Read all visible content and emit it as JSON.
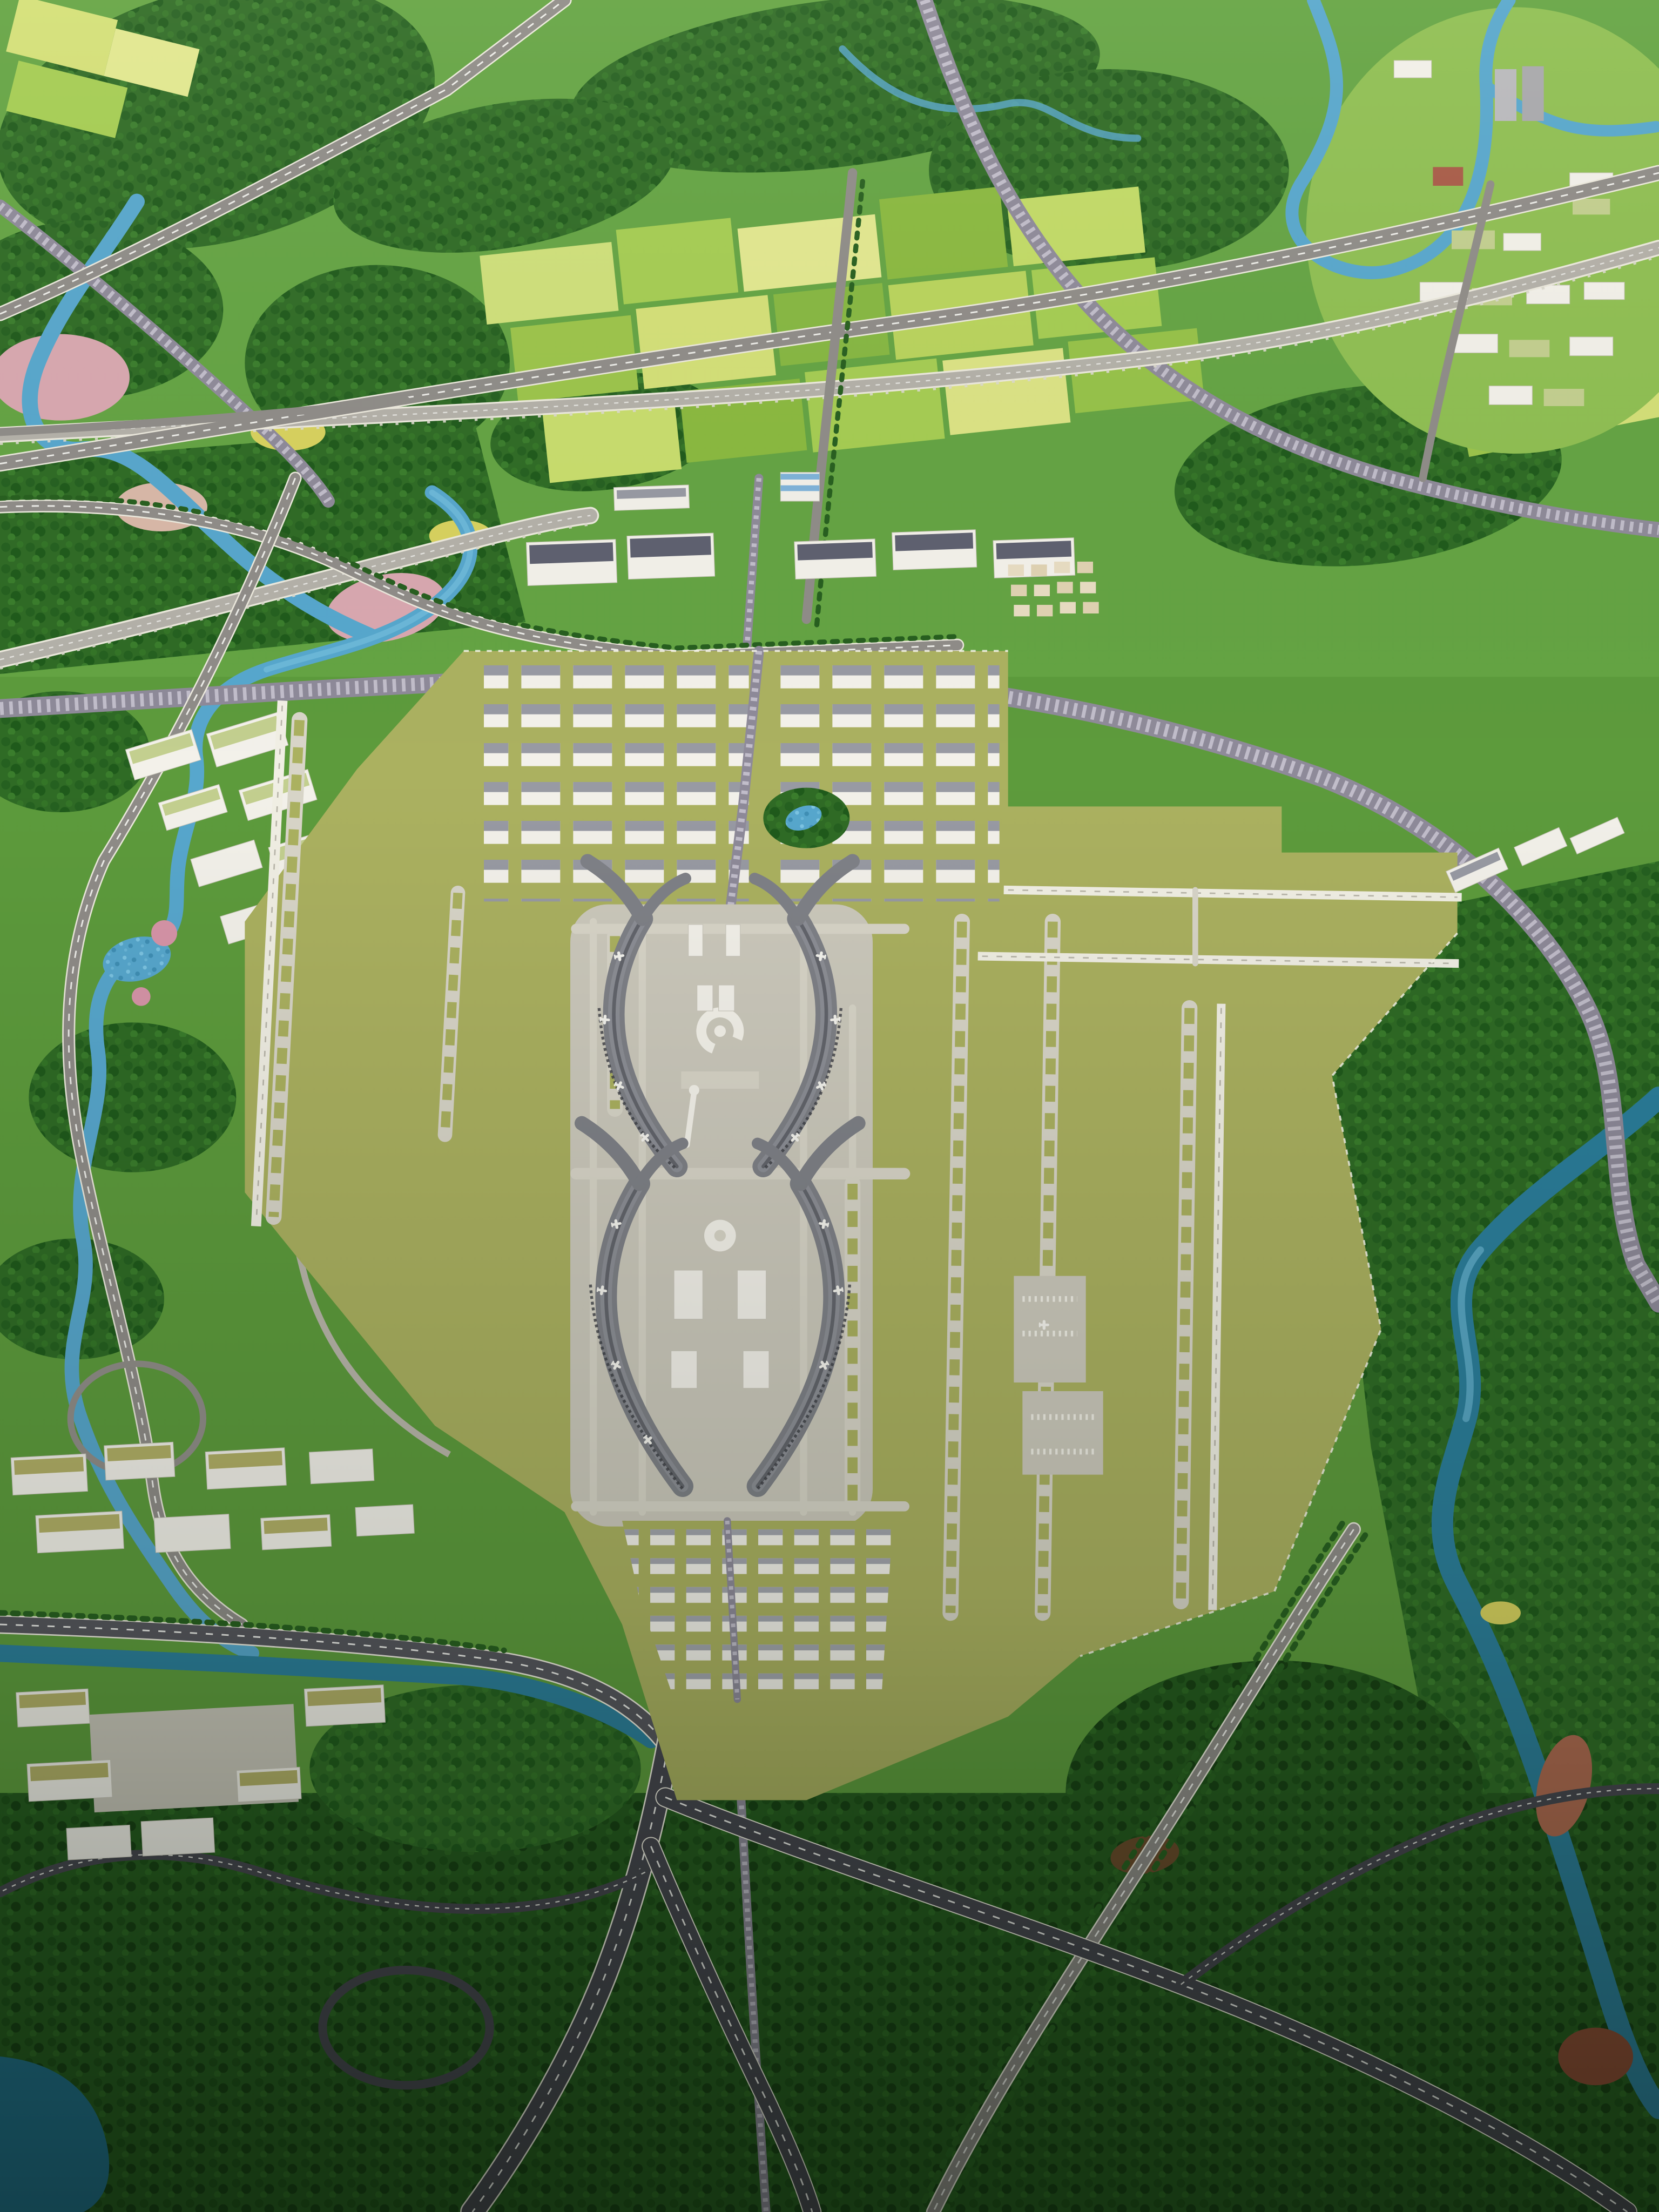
{
  "meta": {
    "title": "Aerial photograph of an airport planning scale model",
    "description": "Overhead photo of a physical architectural scale model: a twin-cluster hub airport with four swallow-wing concourses, olive airfield, white runways and loop taxiways, a logistics warehouse district to the north, a support business district to the south, surrounded by miniature forests, patchwork farmland, winding blue rivers with pink sandbars, elevated expressway viaducts, curved railway corridors and a motorway interchange in the darker foreground.",
    "visible_text": []
  },
  "palette": {
    "base_green": "#5d9b3c",
    "base_green_bright": "#64a443",
    "canopy_green": "#2f6b25",
    "canopy_dark": "#1e4f19",
    "field_light": "#cfe07a",
    "field_mid": "#a5cd52",
    "field_deep": "#86b741",
    "city_green": "#8fbf52",
    "airfield_olive": "#abb160",
    "apron_grey": "#ccc9bc",
    "taxiway_grey": "#d8d5c8",
    "runway_white": "#f1efe4",
    "terminal_roof": "#7f8187",
    "terminal_roof_dark": "#63656c",
    "building_white": "#f3f1ea",
    "roof_grey": "#989aa3",
    "roof_slate": "#5e6170",
    "roof_olive": "#b3b067",
    "river_blue": "#57a7cd",
    "water_teal": "#1f6f8b",
    "sandbar_pink": "#d9a8b0",
    "soil_red": "#9c5238",
    "road_grey": "#8f8c88",
    "road_dark": "#45454e",
    "road_casing": "#ece9dd",
    "viaduct_deck": "#b4b1a9",
    "rail_grey": "#8e8a99",
    "blue_accent": "#7fb3d9"
  },
  "scene": {
    "airport": {
      "terminal_clusters": 2,
      "concourse_wings": 4,
      "itc_ring_building": 1,
      "hotel_cylinder": 1,
      "landside_towers": 2,
      "control_tower": 1,
      "runways": {
        "west_parallel": 1,
        "east_horizontal": 2,
        "east_vertical": 1
      },
      "loop_taxiway_bands": 7,
      "remote_aprons": 2,
      "parked_aircraft": 16
    },
    "districts": [
      {
        "name": "logistics-park",
        "label": "Warehouse logistics park north of the terminals"
      },
      {
        "name": "airfront-town",
        "label": "Factory and office strip along the northern rail corridor"
      },
      {
        "name": "south-support-district",
        "label": "Support business blocks south of the terminals"
      },
      {
        "name": "riverside-town",
        "label": "Terraced riverside town, lower left"
      },
      {
        "name": "hillside-city",
        "label": "High-rise town, upper right"
      },
      {
        "name": "green-roof-campus",
        "label": "Green-roofed campus by the west river"
      }
    ],
    "infrastructure": [
      "elevated-expressway-viaduct",
      "curved-intercity-railway",
      "airport-axis-rail-line",
      "motorway-interchange",
      "tree-lined-avenue",
      "river-bridges"
    ],
    "nature": [
      "dense-model-forest",
      "patchwork-farmland",
      "meandering-river",
      "pink-blossom-groves",
      "wetland-sandbars",
      "teal-lake",
      "red-soil-bank"
    ]
  }
}
